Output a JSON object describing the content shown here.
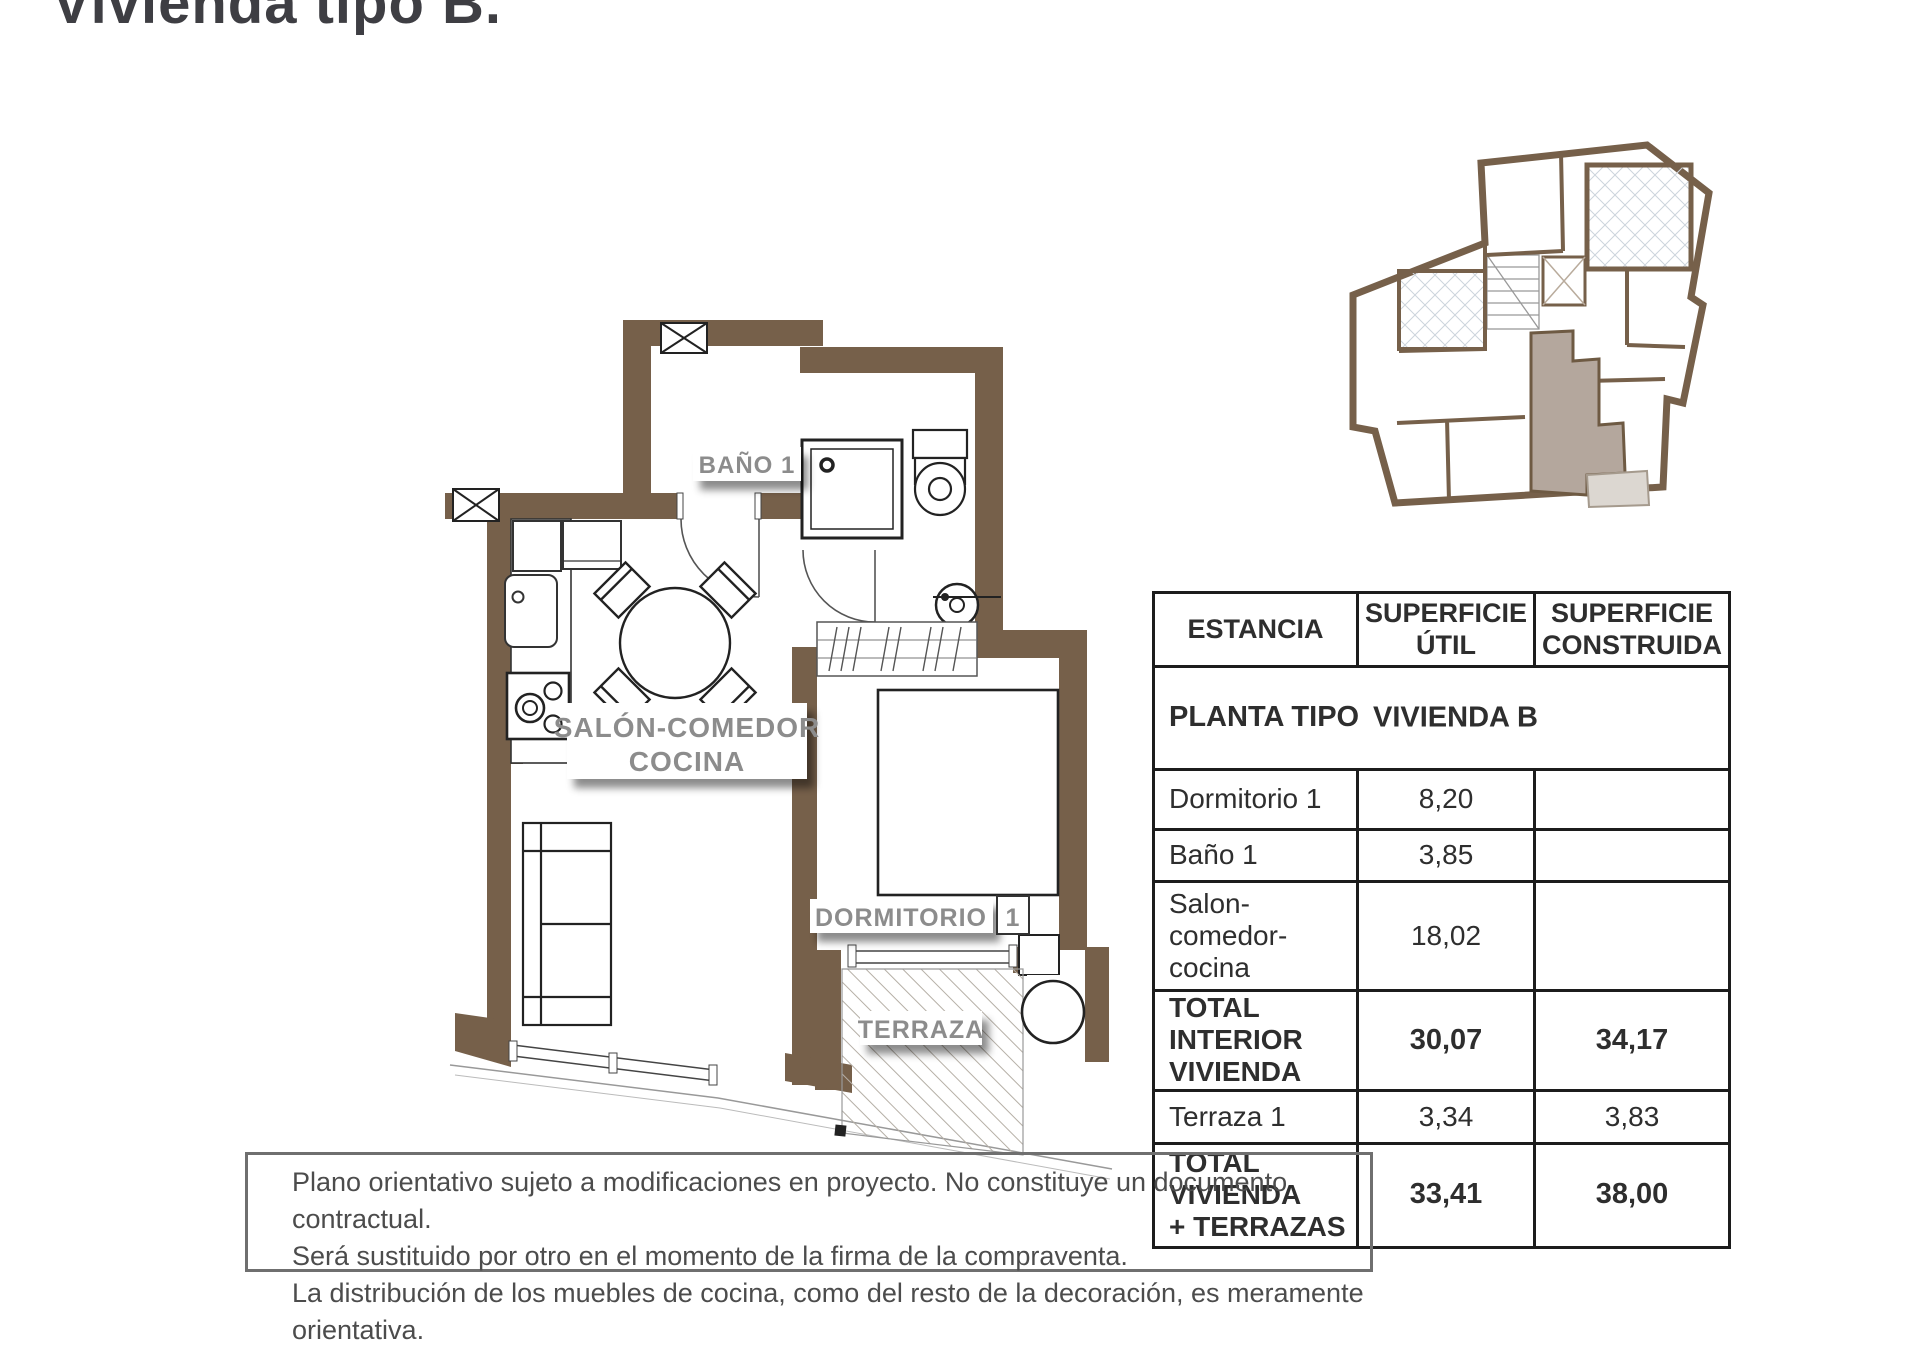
{
  "title": "Vivienda tipo B.",
  "plan": {
    "salon_label_line1": "SALÓN-COMEDOR",
    "salon_label_line2": "COCINA",
    "bano_label": "BAÑO 1",
    "dormitorio_label": "DORMITORIO",
    "dormitorio_number": "1",
    "terraza_label": "TERRAZA"
  },
  "table": {
    "headers": {
      "estancia": "ESTANCIA",
      "util": "SUPERFICIE\nÚTIL",
      "construida": "SUPERFICIE\nCONSTRUIDA"
    },
    "subheader_left": "PLANTA TIPO",
    "subheader_right": "VIVIENDA B",
    "rows": [
      {
        "name": "Dormitorio 1",
        "util": "8,20",
        "construida": ""
      },
      {
        "name": "Baño 1",
        "util": "3,85",
        "construida": ""
      },
      {
        "name": "Salon-\ncomedor-\ncocina",
        "util": "18,02",
        "construida": ""
      },
      {
        "name": "TOTAL INTERIOR\nVIVIENDA",
        "util": "30,07",
        "construida": "34,17"
      },
      {
        "name": "Terraza 1",
        "util": "3,34",
        "construida": "3,83"
      },
      {
        "name": "TOTAL VIVIENDA\n+ TERRAZAS",
        "util": "33,41",
        "construida": "38,00"
      }
    ]
  },
  "footer": {
    "lines": [
      "Plano orientativo sujeto a modificaciones en proyecto. No constituye un documento contractual.",
      "Será sustituido por otro en el momento de la firma de la compraventa.",
      "La distribución de los muebles de cocina, como del resto de la decoración, es meramente orientativa."
    ]
  },
  "colors": {
    "wall_brown": "#76604a",
    "unit_highlight": "#b4a79d",
    "unit_terrace": "#dcd7d1",
    "label_gray": "#8c8c8c"
  }
}
